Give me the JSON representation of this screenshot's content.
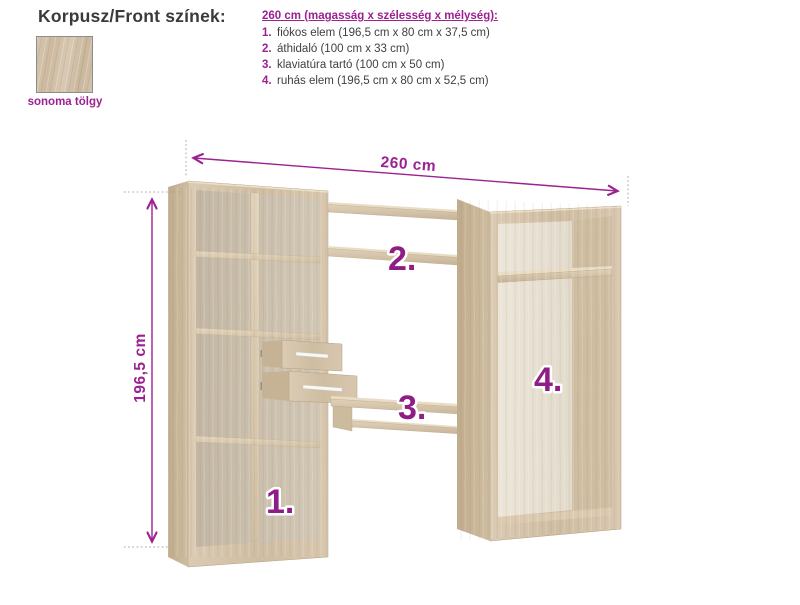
{
  "header": {
    "title": "Korpusz/Front színek:"
  },
  "swatch": {
    "label": "sonoma tölgy",
    "material": "sonoma oak"
  },
  "spec_list": {
    "header": "260 cm (magasság x szélesség x mélység):",
    "items": [
      {
        "num": "1.",
        "text": "fiókos elem (196,5 cm x 80 cm x 37,5 cm)"
      },
      {
        "num": "2.",
        "text": "áthidaló (100 cm x 33 cm)"
      },
      {
        "num": "3.",
        "text": "klaviatúra tartó (100 cm x 50 cm)"
      },
      {
        "num": "4.",
        "text": "ruhás elem (196,5 cm x 80 cm x 52,5 cm)"
      }
    ]
  },
  "diagram": {
    "width_label": "260 cm",
    "height_label": "196,5 cm",
    "part_labels": [
      "1.",
      "2.",
      "3.",
      "4."
    ]
  },
  "colors": {
    "accent_magenta": "#9c2191",
    "part_label_magenta": "#8e1e86",
    "text_dark": "#3a3a3a",
    "wood_light": "#d7c6ae",
    "wood_dark": "#c4b093",
    "wardrobe_back_cream": "#ebe4d7",
    "dim_extension_gray": "#a3a3a3"
  }
}
